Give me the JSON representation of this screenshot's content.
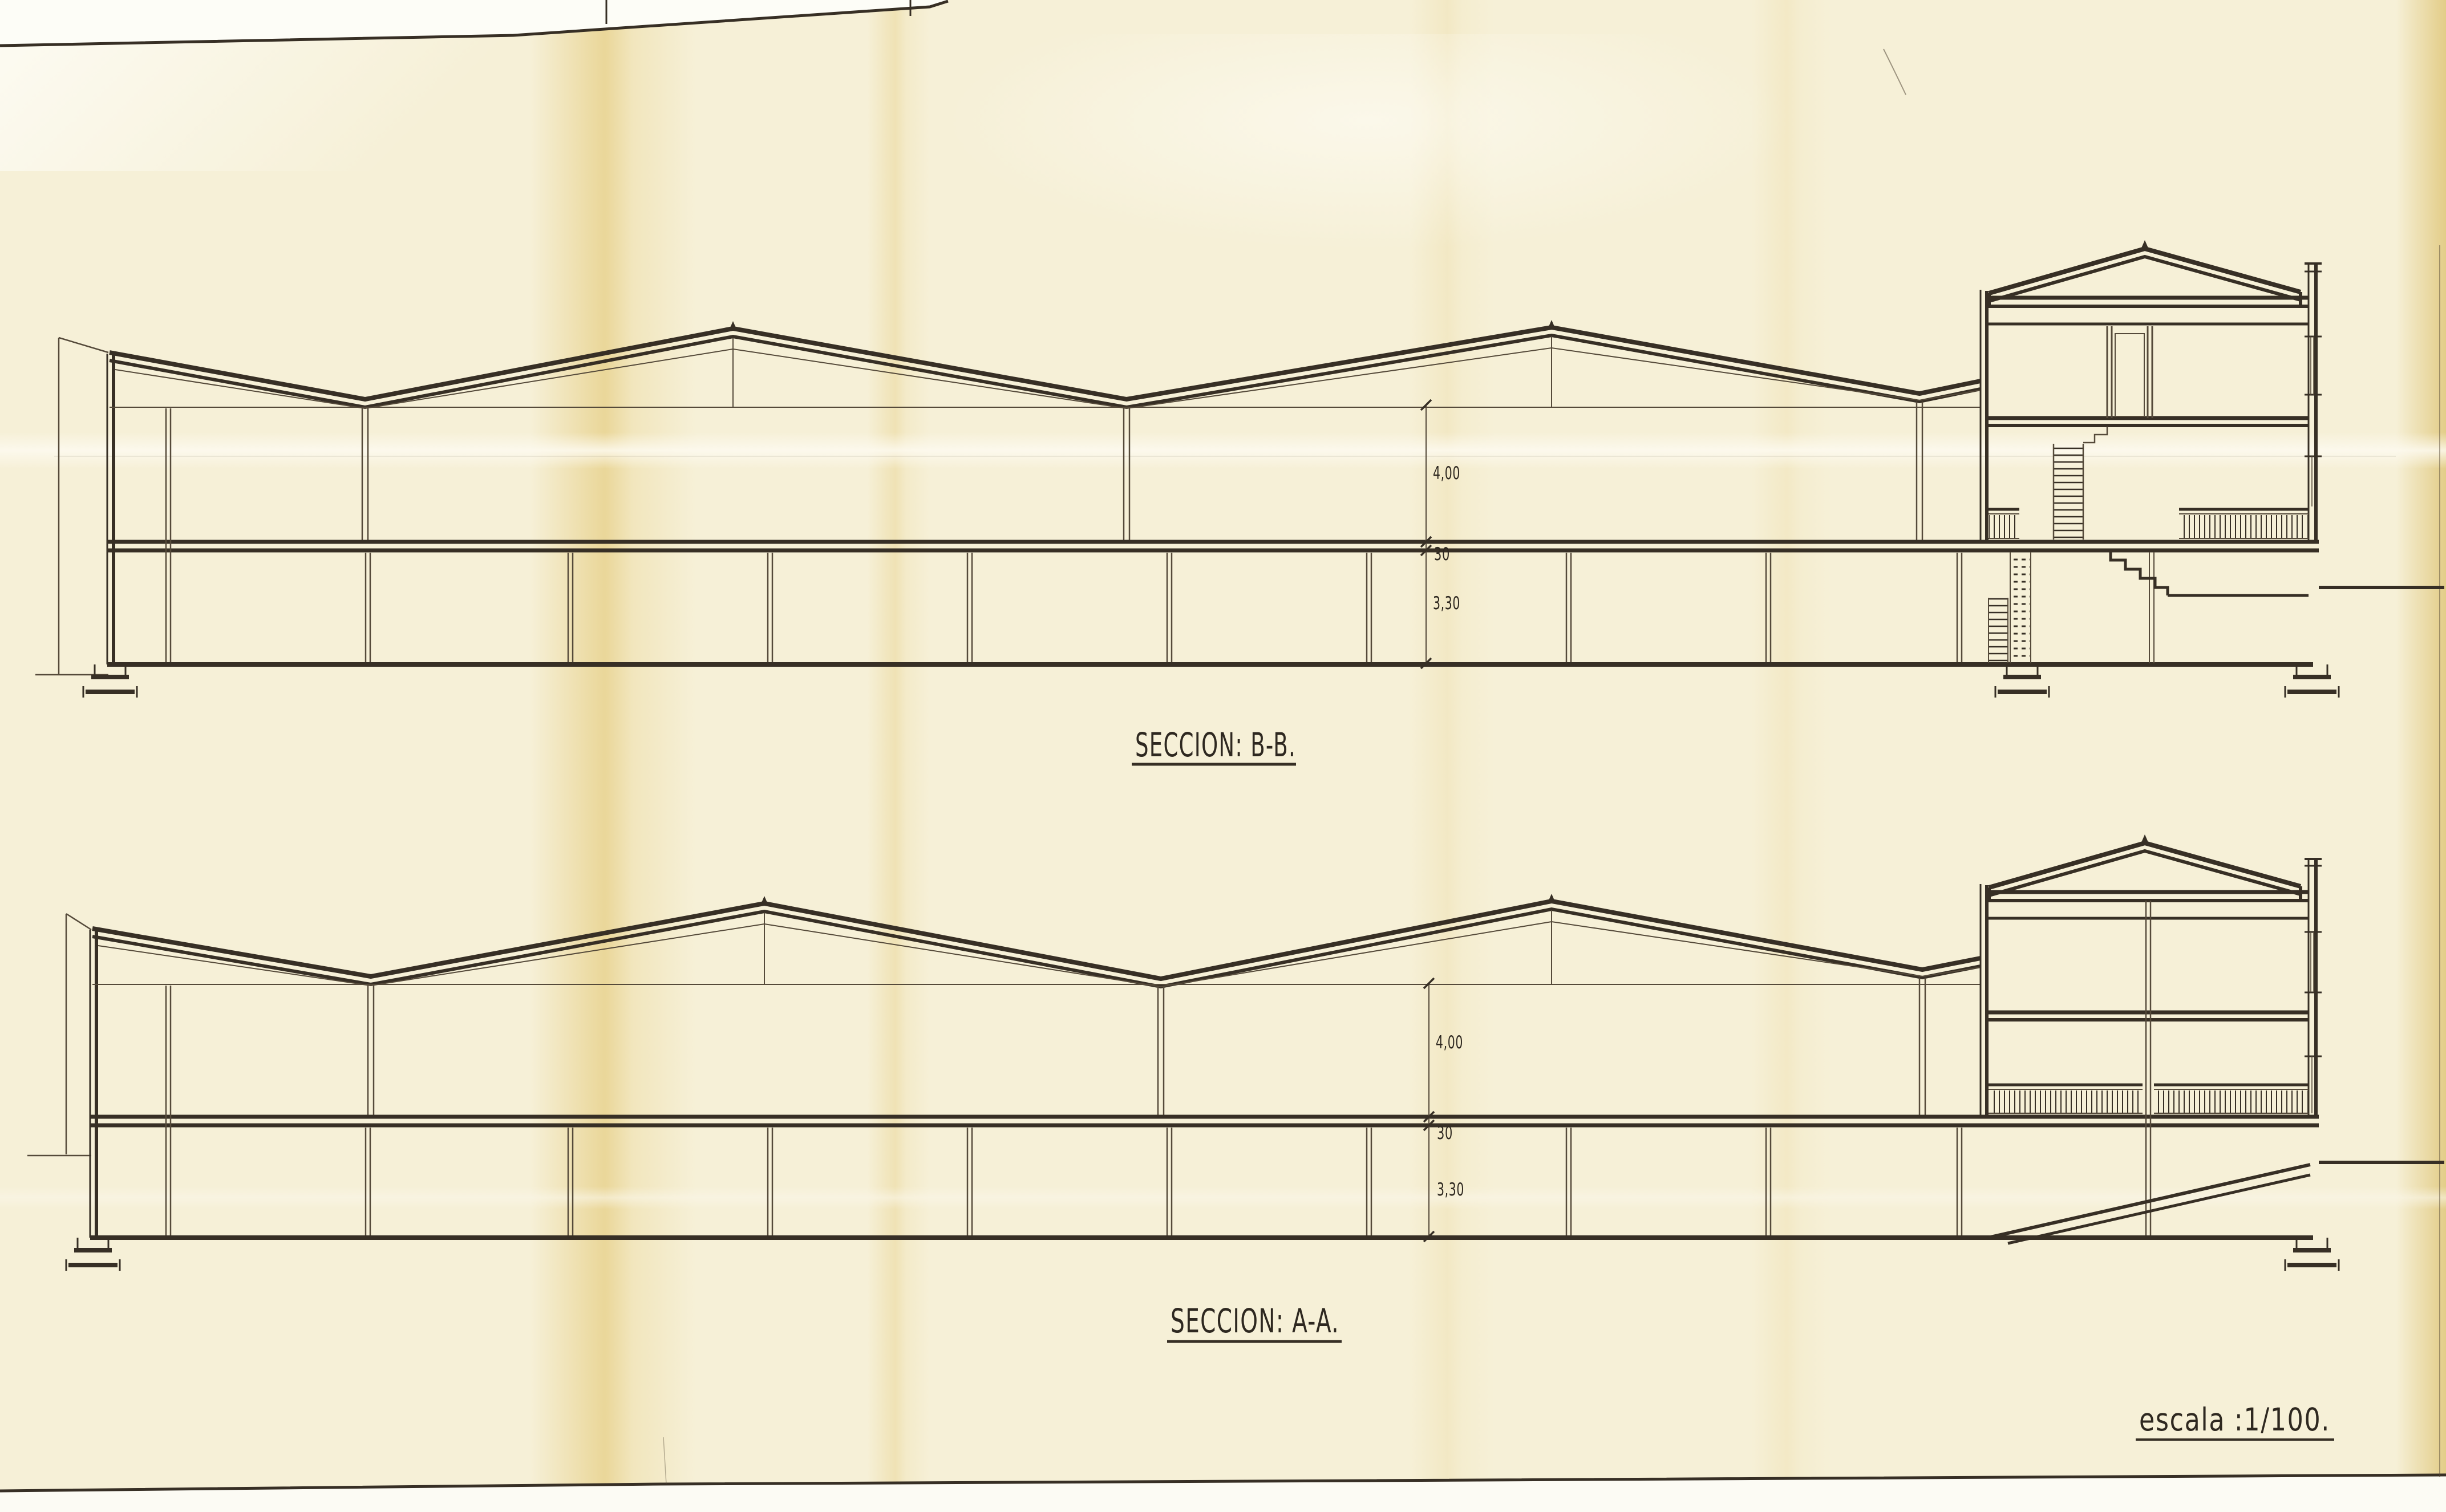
{
  "sheet": {
    "scale_label": "escala :1/100.",
    "sections": [
      {
        "id": "B-B",
        "title": "SECCION: B-B.",
        "dims": {
          "upper_height": "4,00",
          "slab_thickness": "30",
          "lower_height": "3,30"
        }
      },
      {
        "id": "A-A",
        "title": "SECCION: A-A.",
        "dims": {
          "upper_height": "4,00",
          "slab_thickness": "30",
          "lower_height": "3,30"
        }
      }
    ],
    "colors": {
      "ink": "#372f25",
      "paper": "#f6f0d7",
      "fold_band": "#e6ce84",
      "edge_white": "#fdfdf7"
    }
  }
}
